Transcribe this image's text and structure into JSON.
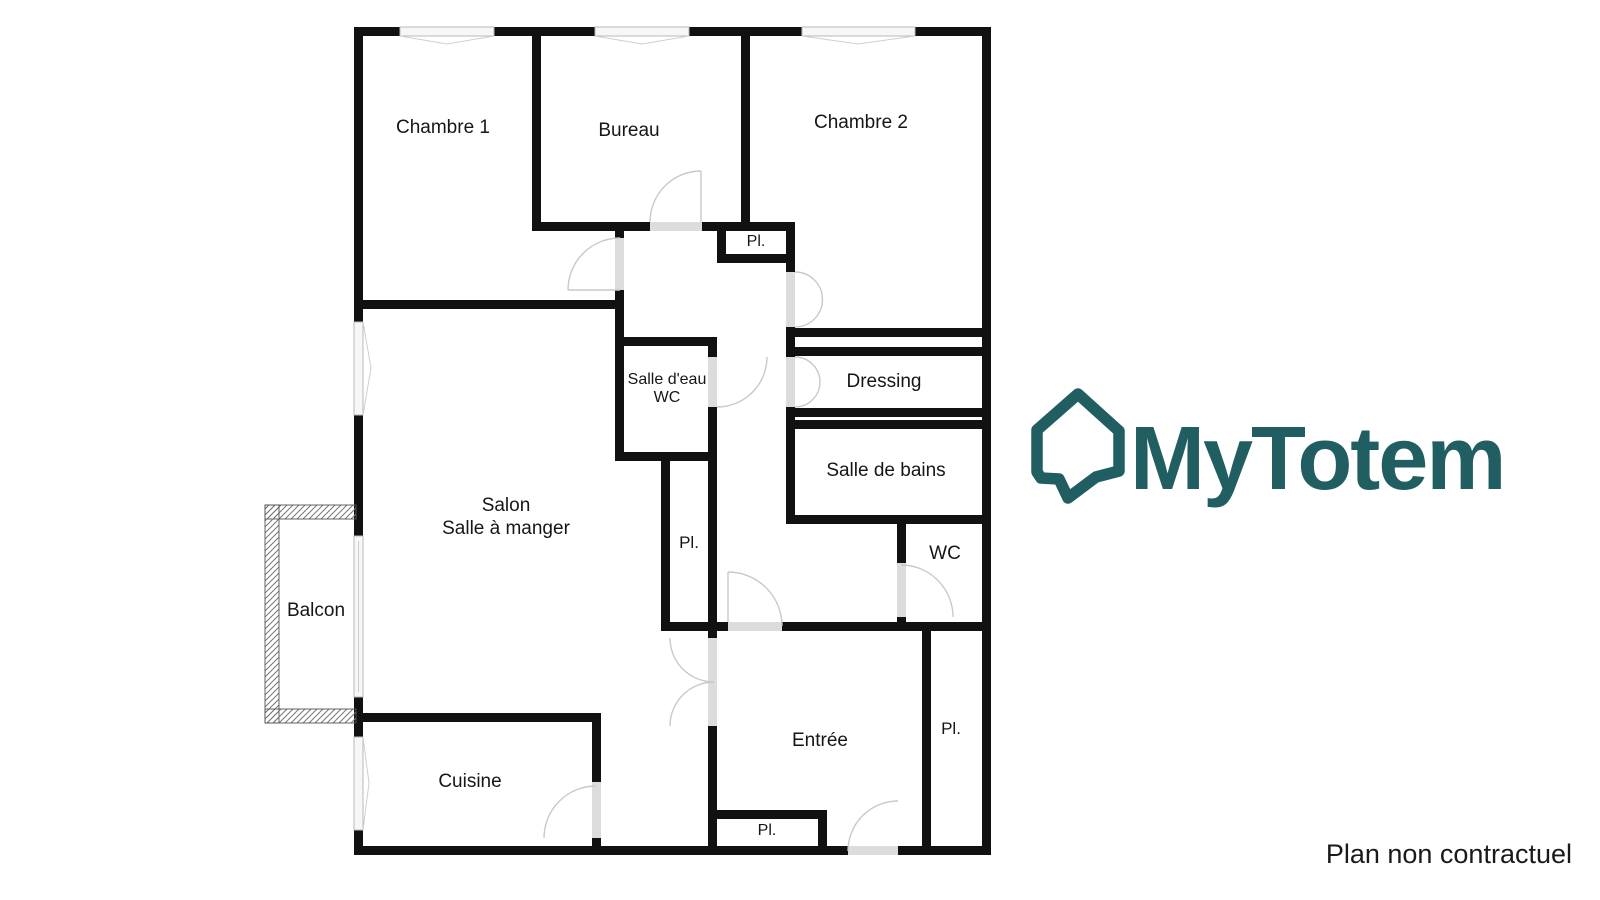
{
  "floor_plan": {
    "rooms": {
      "chambre1": "Chambre 1",
      "bureau": "Bureau",
      "chambre2": "Chambre 2",
      "salle_eau_line1": "Salle d'eau",
      "salle_eau_line2": "WC",
      "dressing": "Dressing",
      "salle_de_bains": "Salle de bains",
      "wc": "WC",
      "salon_line1": "Salon",
      "salon_line2": "Salle à manger",
      "balcon": "Balcon",
      "cuisine": "Cuisine",
      "entree": "Entrée",
      "closet_abbrev": "Pl."
    }
  },
  "logo": {
    "brand": "MyTotem"
  },
  "footer": {
    "disclaimer": "Plan non contractuel"
  },
  "colors": {
    "brand_teal": "#215e62",
    "wall": "#111111",
    "door_opening": "#dcdcdc",
    "swing_arc": "#c9c9c9",
    "window_fill": "#f7f7f7",
    "text": "#161616",
    "background": "#ffffff"
  }
}
